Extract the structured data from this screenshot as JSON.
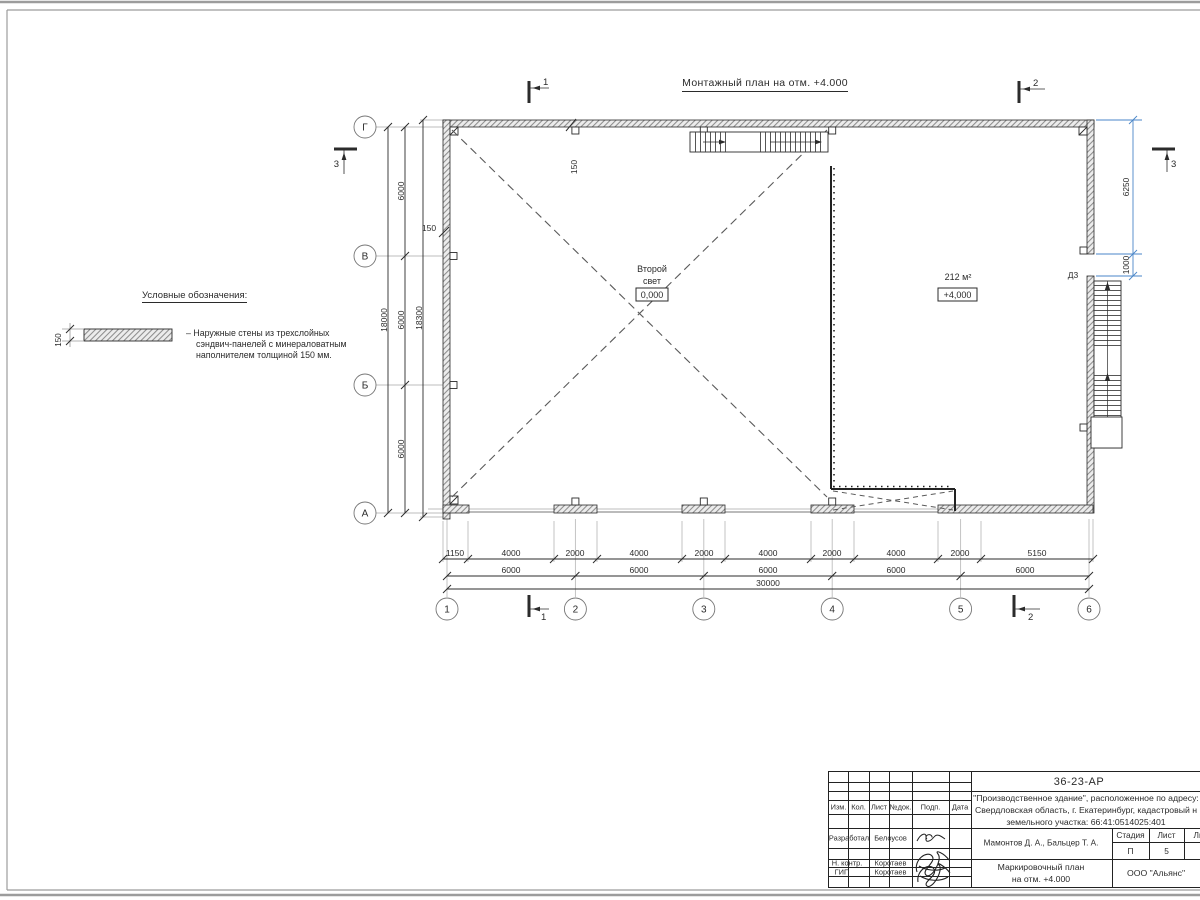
{
  "colors": {
    "blue_dim": "#4a86c8",
    "line": "#2b2b2b",
    "grid_gray": "#bdbdbd",
    "muted_text": "#a8a8a8"
  },
  "drawing_title": "Монтажный план на отм. +4.000",
  "legend": {
    "heading": "Условные обозначения:",
    "thickness": "150",
    "line1": "– Наружные стены из трехслойных",
    "line2": "сэндвич-панелей с минераловатным",
    "line3": "наполнителем толщиной 150 мм."
  },
  "plan": {
    "rooms": {
      "left_line1": "Второй",
      "left_line2": "свет",
      "left_level": "0,000",
      "right_area": "212 м²",
      "right_level": "+4,000"
    },
    "door_label": "Д3",
    "wall_thickness_top": "150",
    "wall_thickness_left": "150",
    "axes": {
      "horizontal": [
        "1",
        "2",
        "3",
        "4",
        "5",
        "6"
      ],
      "vertical": [
        "Г",
        "В",
        "Б",
        "А"
      ]
    },
    "sections": {
      "one": "1",
      "two": "2",
      "three": "3"
    },
    "dims": {
      "left_bay": "6000",
      "left_total": "18000",
      "left_overall": "18300",
      "bottom_row1": [
        "1150",
        "4000",
        "2000",
        "4000",
        "2000",
        "4000",
        "2000",
        "4000",
        "2000",
        "5150"
      ],
      "bottom_row2": "6000",
      "bottom_total": "30000",
      "right_upper": "6250",
      "right_door": "1000"
    }
  },
  "titleblock": {
    "doc_number": "36-23-АР",
    "project_line1": "\"Производственное здание\", расположенное по адресу:",
    "project_line2": "Свердловская область, г. Екатеринбург, кадастровый н",
    "project_line3": "земельного участка: 66:41:0514025:401",
    "headers": {
      "izm": "Изм.",
      "kol": "Кол.",
      "list": "Лист",
      "ndok": "№док.",
      "podp": "Подп.",
      "data": "Дата"
    },
    "rows": {
      "r1_role": "Разработал",
      "r1_name": "Белоусов",
      "r2_role": "Н. контр.",
      "r2_name": "Коротаев",
      "r3_role": "ГИП",
      "r3_name": "Коротаев"
    },
    "authors": "Мамонтов Д. А., Бальцер Т. А.",
    "stage_header": "Стадия",
    "sheet_header": "Лист",
    "sheets_header": "Листов",
    "stage_value": "П",
    "sheet_value": "5",
    "drawing_title_line1": "Маркировочный план",
    "drawing_title_line2": "на отм. +4.000",
    "company": "ООО \"Альянс\""
  }
}
